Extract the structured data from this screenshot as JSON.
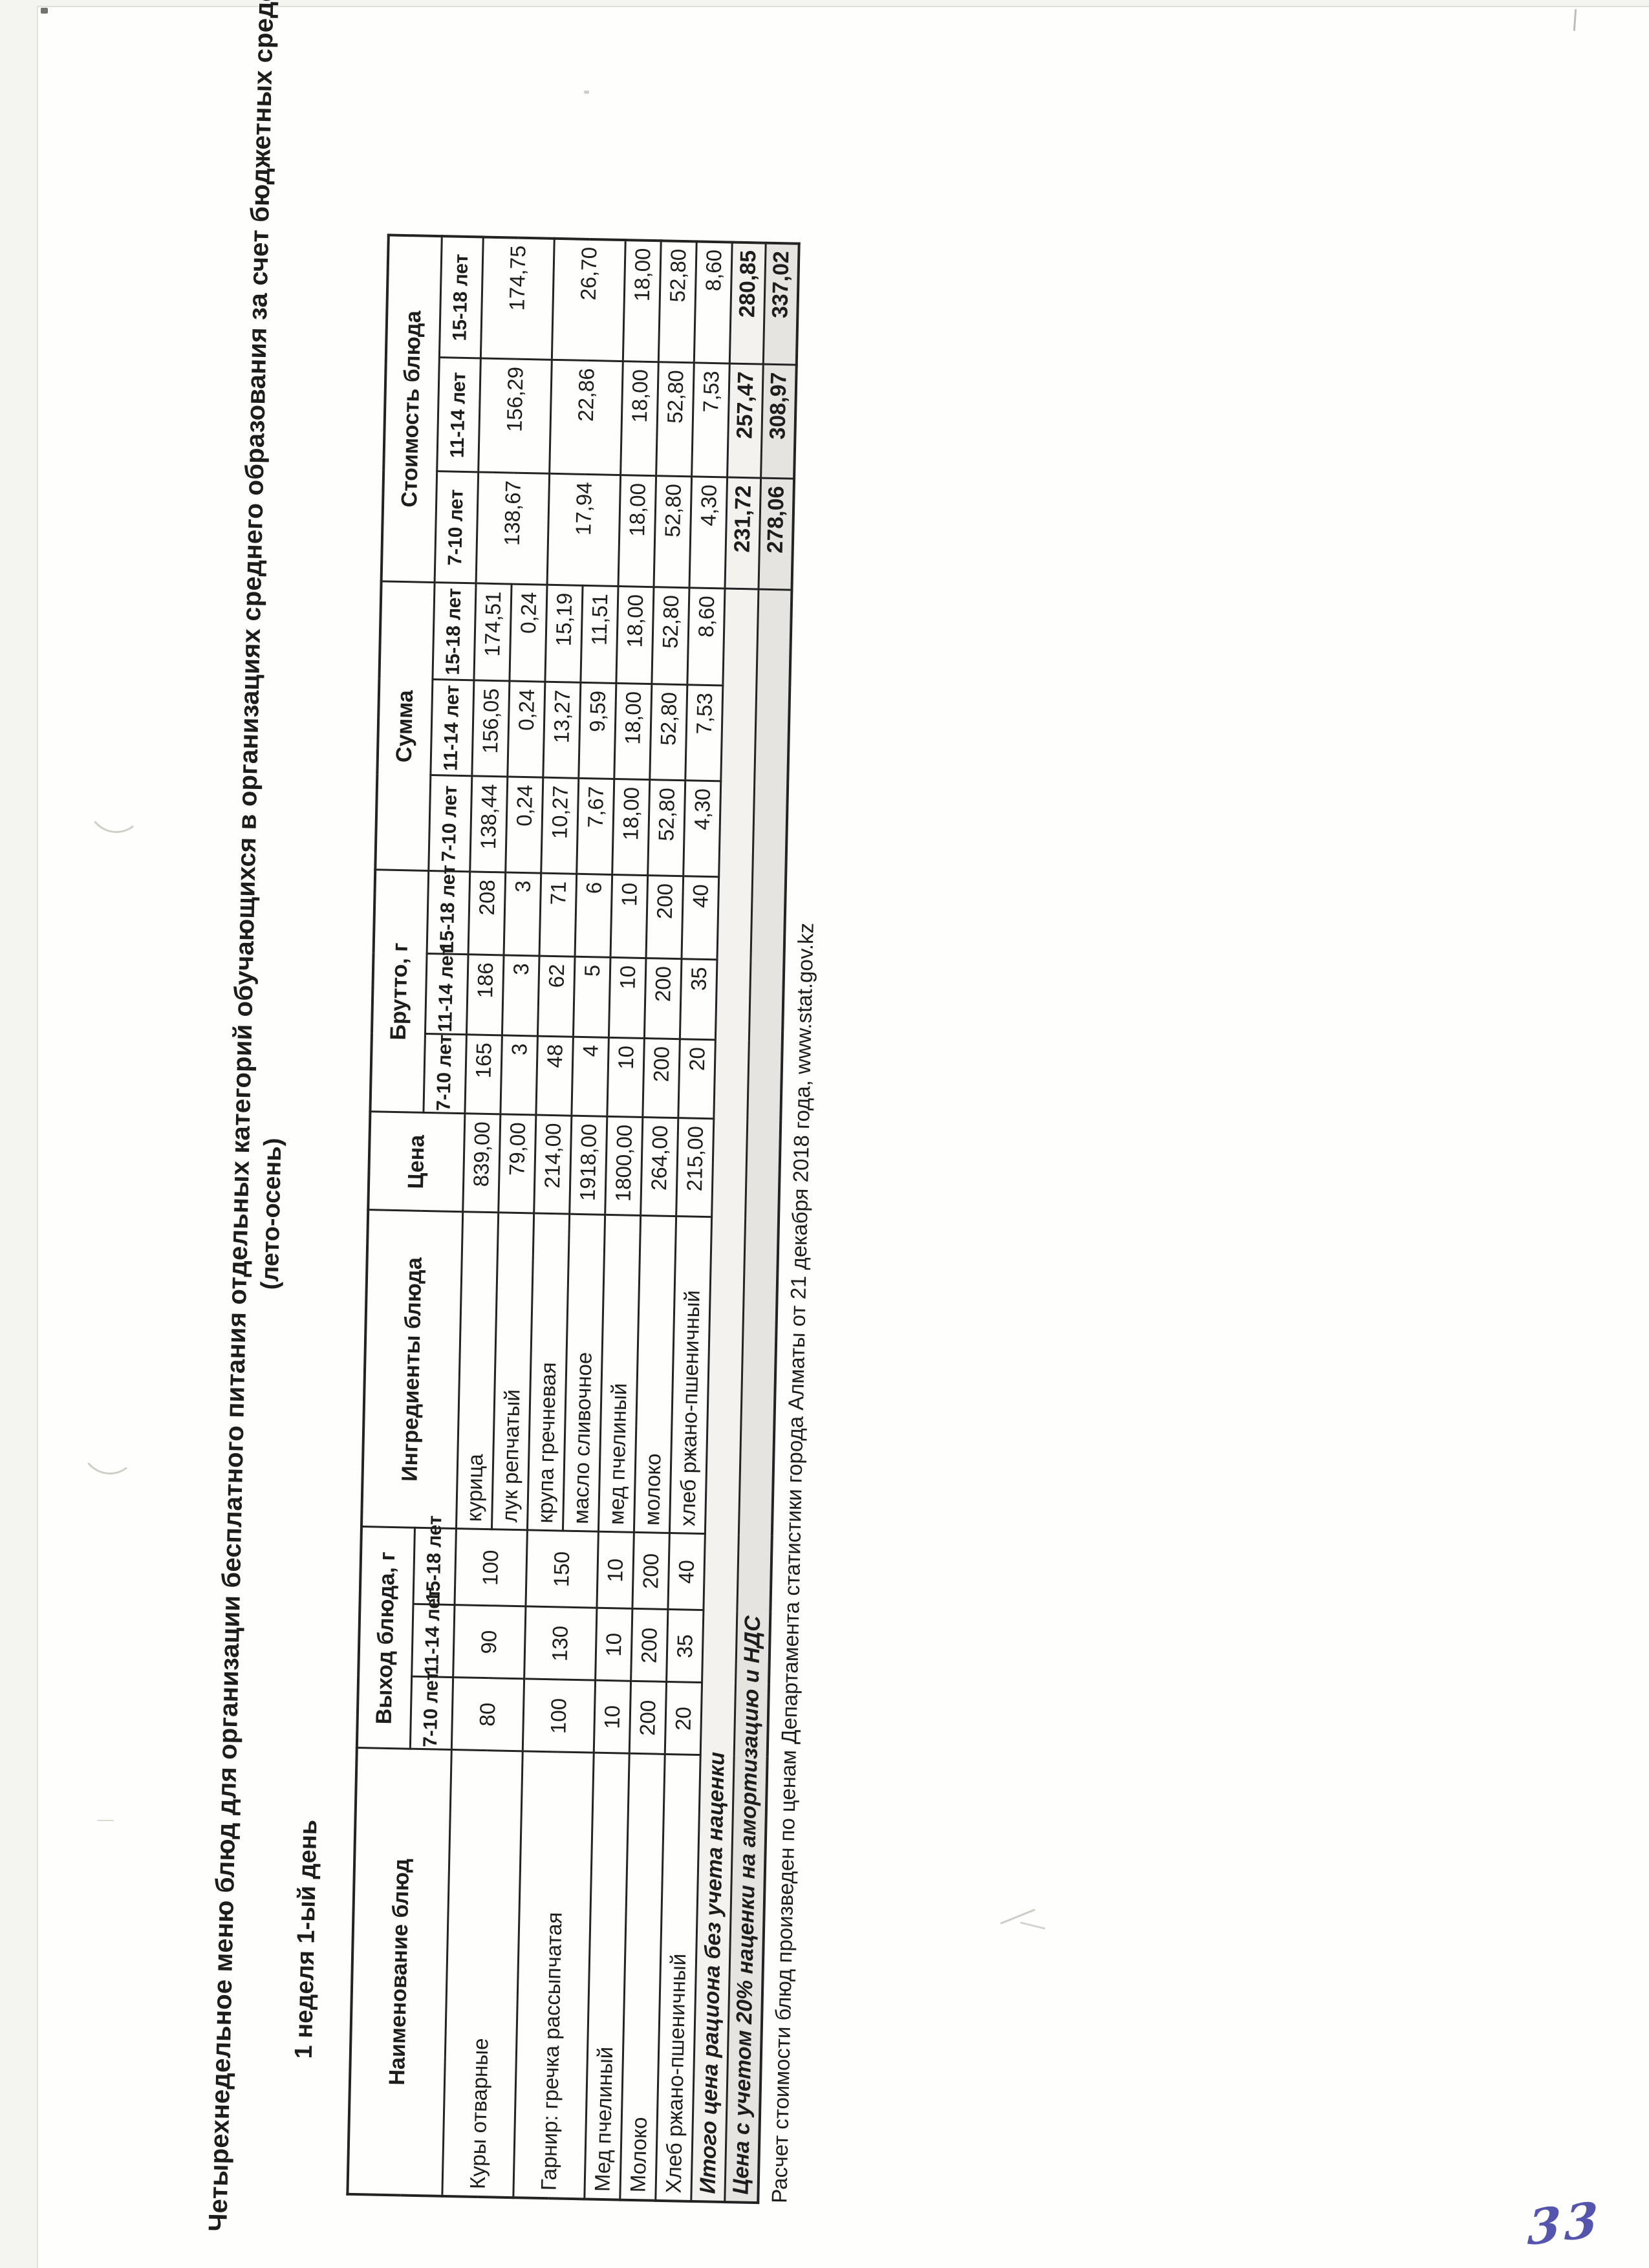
{
  "page": {
    "title": "Четырехнедельное меню блюд для организации бесплатного питания отдельных категорий обучающихся в организациях среднего образования за счет бюджетных средств",
    "season": "(лето-осень)",
    "subtitle": "1 неделя 1-ый день",
    "footnote": "Расчет стоимости блюд произведен по ценам Департамента статистики города Алматы от 21 декабря 2018 года, www.stat.gov.kz",
    "handwritten_page_number": "33"
  },
  "colors": {
    "ink": "#1d1d1d",
    "subtotal_row_shade": "#f3f2ef",
    "markup_row_shade": "#e6e4e0",
    "handwriting_ink": "#4343a6"
  },
  "table": {
    "headers": {
      "dish": "Наименование блюд",
      "output": "Выход блюда, г",
      "ingredients": "Ингредиенты блюда",
      "price": "Цена",
      "brutto": "Брутто, г",
      "sum": "Сумма",
      "cost": "Стоимость блюда",
      "age_groups": [
        "7-10 лет",
        "11-14 лет",
        "15-18 лет"
      ]
    },
    "rows": [
      {
        "dish": "Куры отварные",
        "output": [
          "80",
          "90",
          "100"
        ],
        "cost": [
          "138,67",
          "156,29",
          "174,75"
        ],
        "ingredients": [
          {
            "name": "курица",
            "price": "839,00",
            "brutto": [
              "165",
              "186",
              "208"
            ],
            "sum": [
              "138,44",
              "156,05",
              "174,51"
            ]
          },
          {
            "name": "лук репчатый",
            "price": "79,00",
            "brutto": [
              "3",
              "3",
              "3"
            ],
            "sum": [
              "0,24",
              "0,24",
              "0,24"
            ]
          }
        ]
      },
      {
        "dish": "Гарнир: гречка рассыпчатая",
        "output": [
          "100",
          "130",
          "150"
        ],
        "cost": [
          "17,94",
          "22,86",
          "26,70"
        ],
        "ingredients": [
          {
            "name": "крупа гречневая",
            "price": "214,00",
            "brutto": [
              "48",
              "62",
              "71"
            ],
            "sum": [
              "10,27",
              "13,27",
              "15,19"
            ]
          },
          {
            "name": "масло сливочное",
            "price": "1918,00",
            "brutto": [
              "4",
              "5",
              "6"
            ],
            "sum": [
              "7,67",
              "9,59",
              "11,51"
            ]
          }
        ]
      },
      {
        "dish": "Мед пчелиный",
        "output": [
          "10",
          "10",
          "10"
        ],
        "cost": [
          "18,00",
          "18,00",
          "18,00"
        ],
        "ingredients": [
          {
            "name": "мед пчелиный",
            "price": "1800,00",
            "brutto": [
              "10",
              "10",
              "10"
            ],
            "sum": [
              "18,00",
              "18,00",
              "18,00"
            ]
          }
        ]
      },
      {
        "dish": "Молоко",
        "output": [
          "200",
          "200",
          "200"
        ],
        "cost": [
          "52,80",
          "52,80",
          "52,80"
        ],
        "ingredients": [
          {
            "name": "молоко",
            "price": "264,00",
            "brutto": [
              "200",
              "200",
              "200"
            ],
            "sum": [
              "52,80",
              "52,80",
              "52,80"
            ]
          }
        ]
      },
      {
        "dish": "Хлеб ржано-пшеничный",
        "output": [
          "20",
          "35",
          "40"
        ],
        "cost": [
          "4,30",
          "7,53",
          "8,60"
        ],
        "ingredients": [
          {
            "name": "хлеб ржано-пшеничный",
            "price": "215,00",
            "brutto": [
              "20",
              "35",
              "40"
            ],
            "sum": [
              "4,30",
              "7,53",
              "8,60"
            ]
          }
        ]
      }
    ],
    "totals": [
      {
        "label": "Итого цена рациона без учета наценки",
        "values": [
          "231,72",
          "257,47",
          "280,85"
        ]
      },
      {
        "label": "Цена с учетом 20% наценки на амортизацию и НДС",
        "values": [
          "278,06",
          "308,97",
          "337,02"
        ]
      }
    ]
  }
}
